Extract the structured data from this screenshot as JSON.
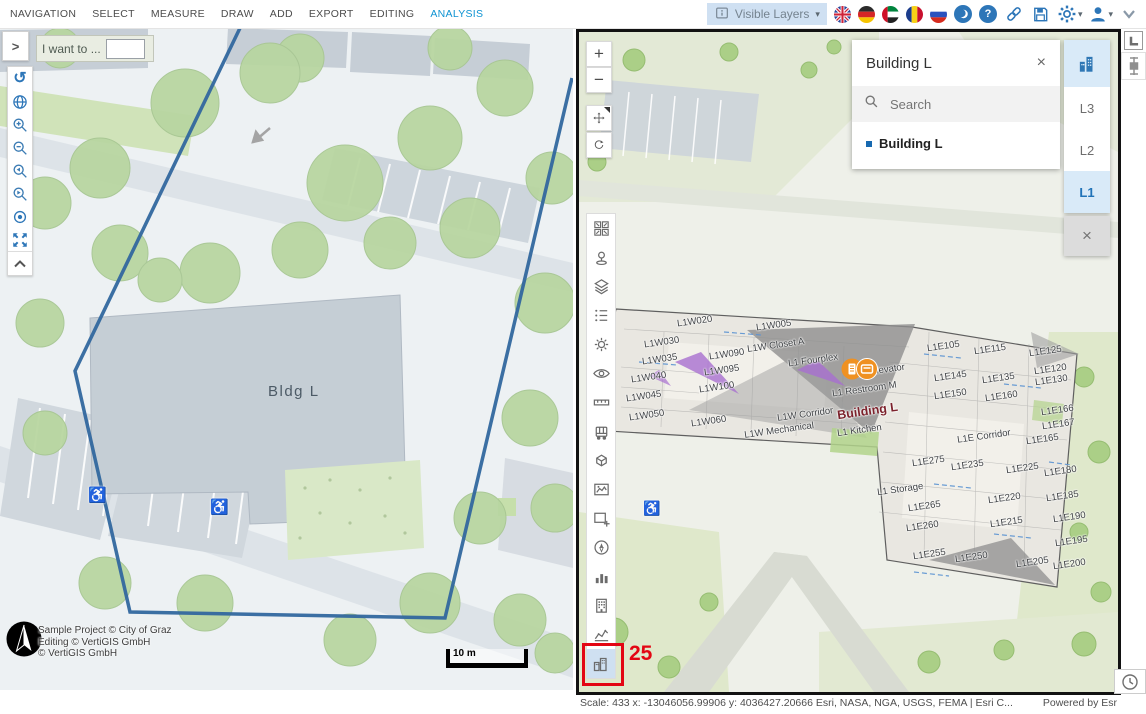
{
  "menubar": {
    "items": [
      "NAVIGATION",
      "SELECT",
      "MEASURE",
      "DRAW",
      "ADD",
      "EXPORT",
      "EDITING",
      "ANALYSIS"
    ],
    "active_item": "ANALYSIS",
    "visible_layers_label": "Visible Layers",
    "language_flags": [
      "uk",
      "germany",
      "uae",
      "romania",
      "russia"
    ],
    "icons": [
      "moon-icon",
      "help-icon",
      "link-icon",
      "save-icon",
      "settings-icon",
      "user-icon",
      "collapse-toolbar-icon"
    ],
    "help_glyph": "?"
  },
  "left_panel": {
    "expander_glyph": ">",
    "i_want_to_label": "I want to ...",
    "i_want_to_value": "",
    "toolbar_icons": [
      "default-tool-icon",
      "home-globe-icon",
      "zoom-in-icon",
      "zoom-out-icon",
      "previous-extent-icon",
      "next-extent-icon",
      "locate-icon",
      "full-extent-icon",
      "collapse-up-icon"
    ],
    "map": {
      "building_label": "Bldg L",
      "attribution_lines": [
        "Sample Project © City of Graz",
        "Editing © VertiGIS GmbH",
        "© VertiGIS GmbH"
      ],
      "scalebar_label": "10 m"
    }
  },
  "right_panel": {
    "nav": {
      "zoom_in": "+",
      "zoom_out": "−"
    },
    "toolbar_icons": [
      "viewpoints-icon",
      "placemark-icon",
      "layers-icon",
      "legend-icon",
      "daylight-icon",
      "visibility-icon",
      "measure-distance-icon",
      "measure-3d-icon",
      "slice-icon",
      "screenshot-icon",
      "add-report-icon",
      "compass-icon",
      "chart-icon",
      "building-explorer-icon",
      "elevation-profile-icon",
      "buildings-3d-icon"
    ],
    "popup": {
      "title": "Building L",
      "search_placeholder": "Search",
      "results": [
        {
          "label": "Building L"
        }
      ]
    },
    "level_filter": {
      "levels": [
        "L3",
        "L2",
        "L1"
      ],
      "selected": "L1",
      "close_label": "×"
    },
    "annotation_number": "25",
    "rooms": [
      [
        "L1W020",
        98,
        284
      ],
      [
        "L1W005",
        177,
        288
      ],
      [
        "L1W030",
        65,
        305
      ],
      [
        "L1W Closet A",
        168,
        308
      ],
      [
        "L1W035",
        63,
        322
      ],
      [
        "L1W090",
        130,
        317
      ],
      [
        "L1 Fourplex",
        209,
        323
      ],
      [
        "L1W095",
        125,
        333
      ],
      [
        "L1 Elevator",
        278,
        333
      ],
      [
        "L1W040",
        52,
        340
      ],
      [
        "L1W100",
        120,
        350
      ],
      [
        "L1 Restroom M",
        253,
        352
      ],
      [
        "L1W045",
        47,
        359
      ],
      [
        "Building L",
        258,
        372,
        1
      ],
      [
        "L1W050",
        50,
        378
      ],
      [
        "L1W060",
        112,
        384
      ],
      [
        "L1W Corridor",
        198,
        377
      ],
      [
        "L1W Mechanical",
        165,
        393
      ],
      [
        "L1 Kitchen",
        258,
        393
      ],
      [
        "L1E105",
        348,
        309
      ],
      [
        "L1E115",
        395,
        312
      ],
      [
        "L1E125",
        450,
        314
      ],
      [
        "L1E120",
        455,
        332
      ],
      [
        "L1E145",
        355,
        339
      ],
      [
        "L1E135",
        403,
        341
      ],
      [
        "L1E130",
        456,
        343
      ],
      [
        "L1E150",
        355,
        357
      ],
      [
        "L1E160",
        406,
        359
      ],
      [
        "L1E166",
        462,
        373
      ],
      [
        "L1E167",
        463,
        387
      ],
      [
        "L1E Corridor",
        378,
        399
      ],
      [
        "L1E165",
        447,
        402
      ],
      [
        "L1E275",
        333,
        424
      ],
      [
        "L1E235",
        372,
        428
      ],
      [
        "L1E225",
        427,
        431
      ],
      [
        "L1E180",
        465,
        434
      ],
      [
        "L1 Storage",
        298,
        452
      ],
      [
        "L1E265",
        329,
        469
      ],
      [
        "L1E220",
        409,
        461
      ],
      [
        "L1E185",
        467,
        459
      ],
      [
        "L1E260",
        327,
        489
      ],
      [
        "L1E215",
        411,
        485
      ],
      [
        "L1E190",
        474,
        480
      ],
      [
        "L1E195",
        476,
        504
      ],
      [
        "L1E255",
        334,
        517
      ],
      [
        "L1E250",
        376,
        520
      ],
      [
        "L1E205",
        437,
        525
      ],
      [
        "L1E200",
        474,
        527
      ]
    ],
    "statusbar": {
      "left": "Scale: 433  x: -13046056.99906 y: 4036427.20666  Esri, NASA, NGA, USGS, FEMA | Esri C...",
      "right": "Powered by Esr"
    }
  },
  "side_strip": {
    "icons": [
      "dock-layout-icon",
      "swipe-vertical-icon",
      "clock-icon"
    ]
  },
  "colors": {
    "accent_blue": "#2d76b8",
    "active_tab": "#0f93d2",
    "selection_bg": "#d9eaf8",
    "annotation_red": "#e30613",
    "polygon_blue": "#31679e"
  }
}
